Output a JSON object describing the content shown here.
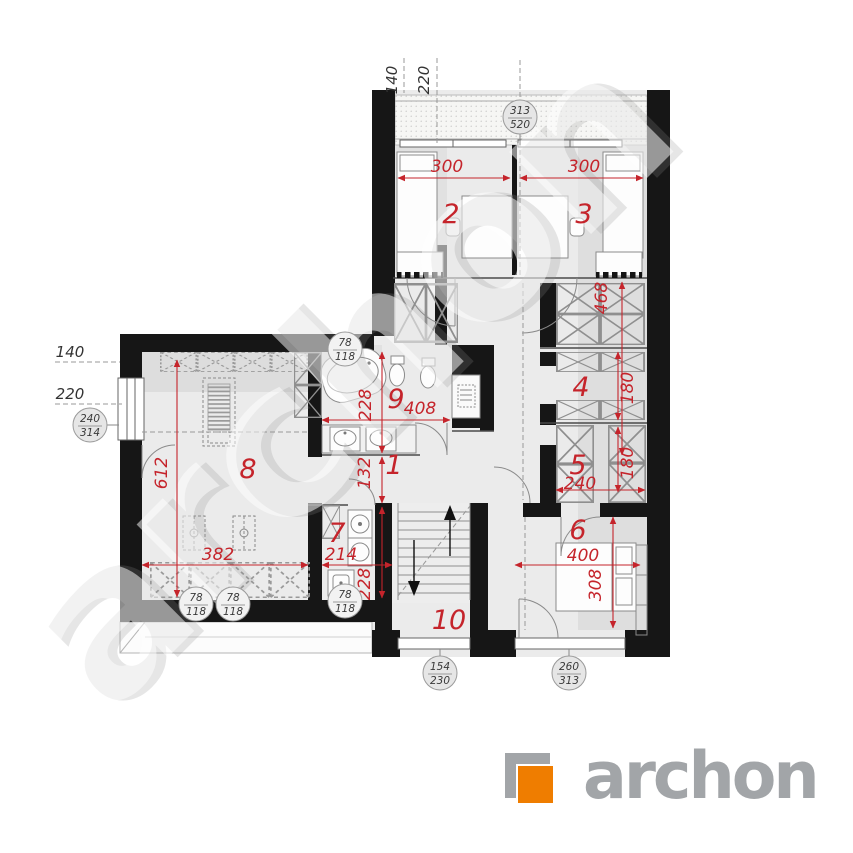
{
  "watermark": "archon",
  "logo": {
    "name": "archon"
  },
  "axis_labels": {
    "top_140": "140",
    "top_220": "220",
    "left_140": "140",
    "left_220": "220"
  },
  "rooms": {
    "r1": "1",
    "r2": "2",
    "r3": "3",
    "r4": "4",
    "r5": "5",
    "r6": "6",
    "r7": "7",
    "r8": "8",
    "r9": "9",
    "r10": "10"
  },
  "dimensions": {
    "room2_width": "300",
    "room3_width": "300",
    "right_depth": "468",
    "room4_depth": "180",
    "room5_width": "240",
    "room5_depth": "180",
    "room6_width": "400",
    "room6_depth": "308",
    "room8_height": "612",
    "room8_width": "382",
    "room9_depth": "228",
    "room9_width": "408",
    "hall_depth": "132",
    "room7_width": "214",
    "room7_depth": "228"
  },
  "window_tags": {
    "w313_520": {
      "top": "313",
      "bottom": "520"
    },
    "w240_314": {
      "top": "240",
      "bottom": "314"
    },
    "w78_118": {
      "top": "78",
      "bottom": "118"
    },
    "w154_230": {
      "top": "154",
      "bottom": "230"
    },
    "w260_313": {
      "top": "260",
      "bottom": "313"
    }
  }
}
